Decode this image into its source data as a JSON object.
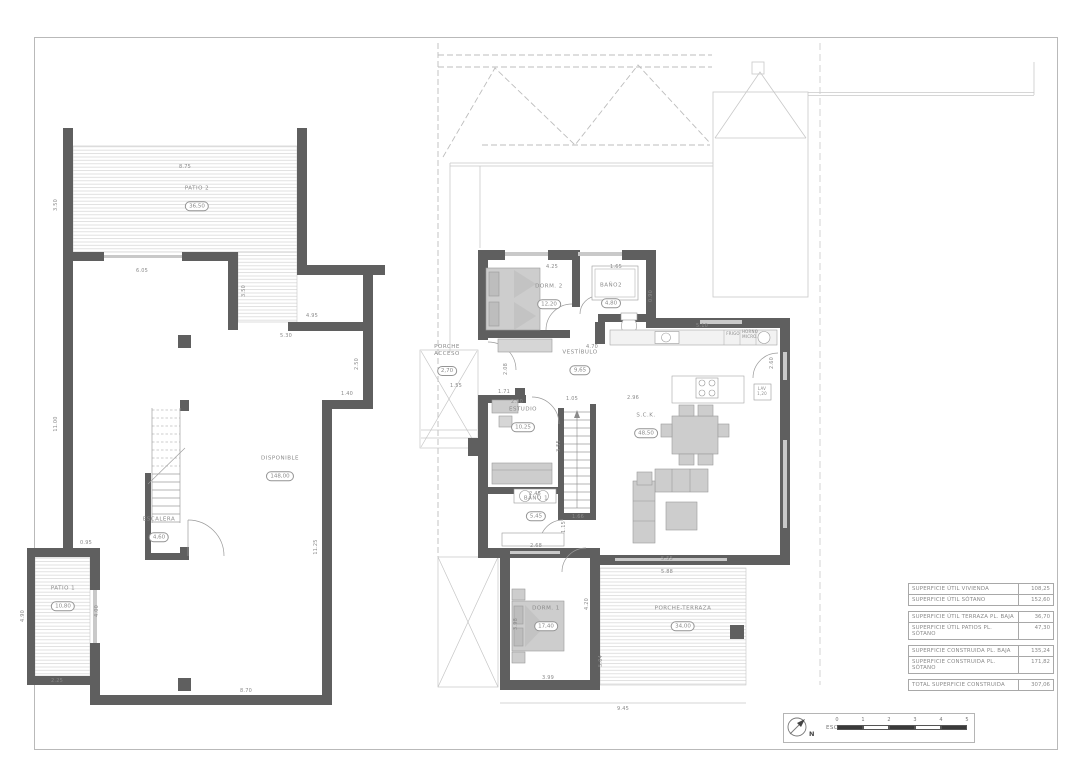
{
  "scalebar": {
    "label": "ESCALA :",
    "north": "N",
    "ticks": [
      "0",
      "1",
      "2",
      "3",
      "4",
      "5"
    ],
    "segments": [
      1,
      0,
      1,
      0,
      1
    ]
  },
  "table": {
    "groups": [
      {
        "rows": [
          {
            "label": "SUPERFICIE ÚTIL VIVIENDA",
            "value": "108,25"
          },
          {
            "label": "SUPERFICIE ÚTIL SÓTANO",
            "value": "152,60"
          }
        ]
      },
      {
        "rows": [
          {
            "label": "SUPERFICIE ÚTIL TERRAZA PL. BAJA",
            "value": "36,70"
          },
          {
            "label": "SUPERFICIE ÚTIL PATIOS PL. SÓTANO",
            "value": "47,30"
          }
        ]
      },
      {
        "rows": [
          {
            "label": "SUPERFICIE CONSTRUIDA PL. BAJA",
            "value": "135,24"
          },
          {
            "label": "SUPERFICIE CONSTRUIDA PL. SÓTANO",
            "value": "171,82"
          }
        ]
      },
      {
        "rows": [
          {
            "label": "TOTAL SUPERFICIE CONSTRUIDA",
            "value": "307,06"
          }
        ]
      }
    ]
  },
  "rooms": [
    {
      "name": "PATIO 2",
      "area": "36,50",
      "x": 197,
      "y": 198
    },
    {
      "name": "DISPONIBLE",
      "area": "148,00",
      "x": 280,
      "y": 468
    },
    {
      "name": "ESCALERA",
      "area": "4,60",
      "x": 159,
      "y": 529
    },
    {
      "name": "PATIO 1",
      "area": "10,80",
      "x": 63,
      "y": 598
    },
    {
      "name": "DORM. 2",
      "area": "12,20",
      "x": 549,
      "y": 296
    },
    {
      "name": "BAÑO2",
      "area": "4,80",
      "x": 611,
      "y": 295
    },
    {
      "name": "VESTÍBULO",
      "area": "9,65",
      "x": 580,
      "y": 362
    },
    {
      "name": "PORCHE\nACCESO",
      "area": "2,70",
      "x": 447,
      "y": 360
    },
    {
      "name": "ESTUDIO",
      "area": "10,25",
      "x": 523,
      "y": 419
    },
    {
      "name": "S.C.K.",
      "area": "48,50",
      "x": 646,
      "y": 425
    },
    {
      "name": "BAÑO 1",
      "area": "5,45",
      "x": 536,
      "y": 508
    },
    {
      "name": "DORM. 1",
      "area": "17,40",
      "x": 546,
      "y": 618
    },
    {
      "name": "PORCHE-TERRAZA",
      "area": "34,00",
      "x": 683,
      "y": 618
    }
  ],
  "dims": [
    {
      "t": "8.75",
      "x": 185,
      "y": 167
    },
    {
      "t": "3.50",
      "x": 56,
      "y": 205,
      "v": 1
    },
    {
      "t": "6.05",
      "x": 142,
      "y": 271
    },
    {
      "t": "3.50",
      "x": 244,
      "y": 291,
      "v": 1
    },
    {
      "t": "4.95",
      "x": 312,
      "y": 316
    },
    {
      "t": "5.30",
      "x": 286,
      "y": 336
    },
    {
      "t": "2.50",
      "x": 357,
      "y": 364,
      "v": 1
    },
    {
      "t": "1.40",
      "x": 347,
      "y": 394
    },
    {
      "t": "11.00",
      "x": 56,
      "y": 424,
      "v": 1
    },
    {
      "t": "11.25",
      "x": 316,
      "y": 547,
      "v": 1
    },
    {
      "t": "0.95",
      "x": 86,
      "y": 543
    },
    {
      "t": "4.90",
      "x": 23,
      "y": 616,
      "v": 1
    },
    {
      "t": "4.00",
      "x": 97,
      "y": 611,
      "v": 1
    },
    {
      "t": "2.25",
      "x": 57,
      "y": 681
    },
    {
      "t": "8.70",
      "x": 246,
      "y": 691
    },
    {
      "t": "4.25",
      "x": 552,
      "y": 267
    },
    {
      "t": "1.65",
      "x": 616,
      "y": 267
    },
    {
      "t": "4.70",
      "x": 592,
      "y": 347
    },
    {
      "t": "0.90",
      "x": 651,
      "y": 296,
      "v": 1
    },
    {
      "t": "5.10",
      "x": 702,
      "y": 326
    },
    {
      "t": "2.96",
      "x": 633,
      "y": 398
    },
    {
      "t": "2.60",
      "x": 772,
      "y": 363,
      "v": 1
    },
    {
      "t": "1.55",
      "x": 456,
      "y": 386
    },
    {
      "t": "2.08",
      "x": 506,
      "y": 369,
      "v": 1
    },
    {
      "t": "1.71",
      "x": 504,
      "y": 392
    },
    {
      "t": "2.90",
      "x": 517,
      "y": 402
    },
    {
      "t": "1.05",
      "x": 572,
      "y": 399
    },
    {
      "t": "3.55",
      "x": 559,
      "y": 446,
      "v": 1
    },
    {
      "t": "2.45",
      "x": 535,
      "y": 494
    },
    {
      "t": "1.15",
      "x": 564,
      "y": 527,
      "v": 1
    },
    {
      "t": "1.66",
      "x": 578,
      "y": 517
    },
    {
      "t": "2.68",
      "x": 536,
      "y": 546
    },
    {
      "t": "3.98",
      "x": 516,
      "y": 624,
      "v": 1
    },
    {
      "t": "4.20",
      "x": 587,
      "y": 604,
      "v": 1
    },
    {
      "t": "5.04",
      "x": 601,
      "y": 661,
      "v": 1
    },
    {
      "t": "3.99",
      "x": 548,
      "y": 678
    },
    {
      "t": "5.55",
      "x": 667,
      "y": 559
    },
    {
      "t": "5.88",
      "x": 667,
      "y": 572
    },
    {
      "t": "9.45",
      "x": 623,
      "y": 709
    },
    {
      "t": "FRIGO",
      "x": 733,
      "y": 334,
      "s": 1
    },
    {
      "t": "HORNO",
      "x": 750,
      "y": 332,
      "s": 1
    },
    {
      "t": "MICRO.",
      "x": 750,
      "y": 337,
      "s": 1
    },
    {
      "t": "LAV",
      "x": 762,
      "y": 389,
      "s": 1
    },
    {
      "t": "1,20",
      "x": 762,
      "y": 394,
      "s": 1
    }
  ]
}
